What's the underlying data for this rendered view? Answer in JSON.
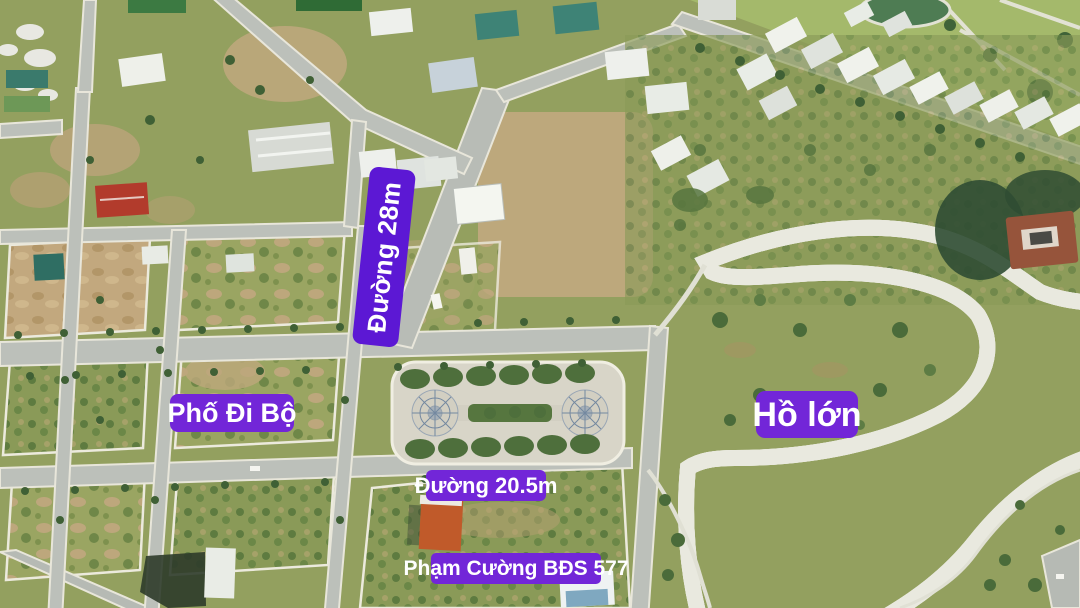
{
  "labels": {
    "road_28m": {
      "text": "Đường 28m",
      "background": "#5c18d4",
      "text_color": "#ffffff",
      "orientation": "vertical"
    },
    "walking_street": {
      "text": "Phố Đi Bộ",
      "background": "#7226d8",
      "text_color": "#ffffff"
    },
    "big_lake": {
      "text": "Hồ lớn",
      "background": "#7226d8",
      "text_color": "#ffffff"
    },
    "road_20_5m": {
      "text": "Đường 20.5m",
      "background": "#7226d8",
      "text_color": "#ffffff"
    },
    "agency": {
      "text": "Phạm Cường BĐS 577",
      "background": "#7226d8",
      "text_color": "#ffffff"
    }
  },
  "palette": {
    "lake_water": "#69a66d",
    "road_asphalt": "#bcc0ba",
    "curb_white": "#e9e7db",
    "dirt": "#c2a87e",
    "grass": "#93a05f",
    "shore_vegetation": "#3d5931",
    "promenade_path": "#e9e9df",
    "red_roof": "#b23b2c",
    "orange_roof": "#c05a2a",
    "teal_roof": "#3e8376"
  }
}
